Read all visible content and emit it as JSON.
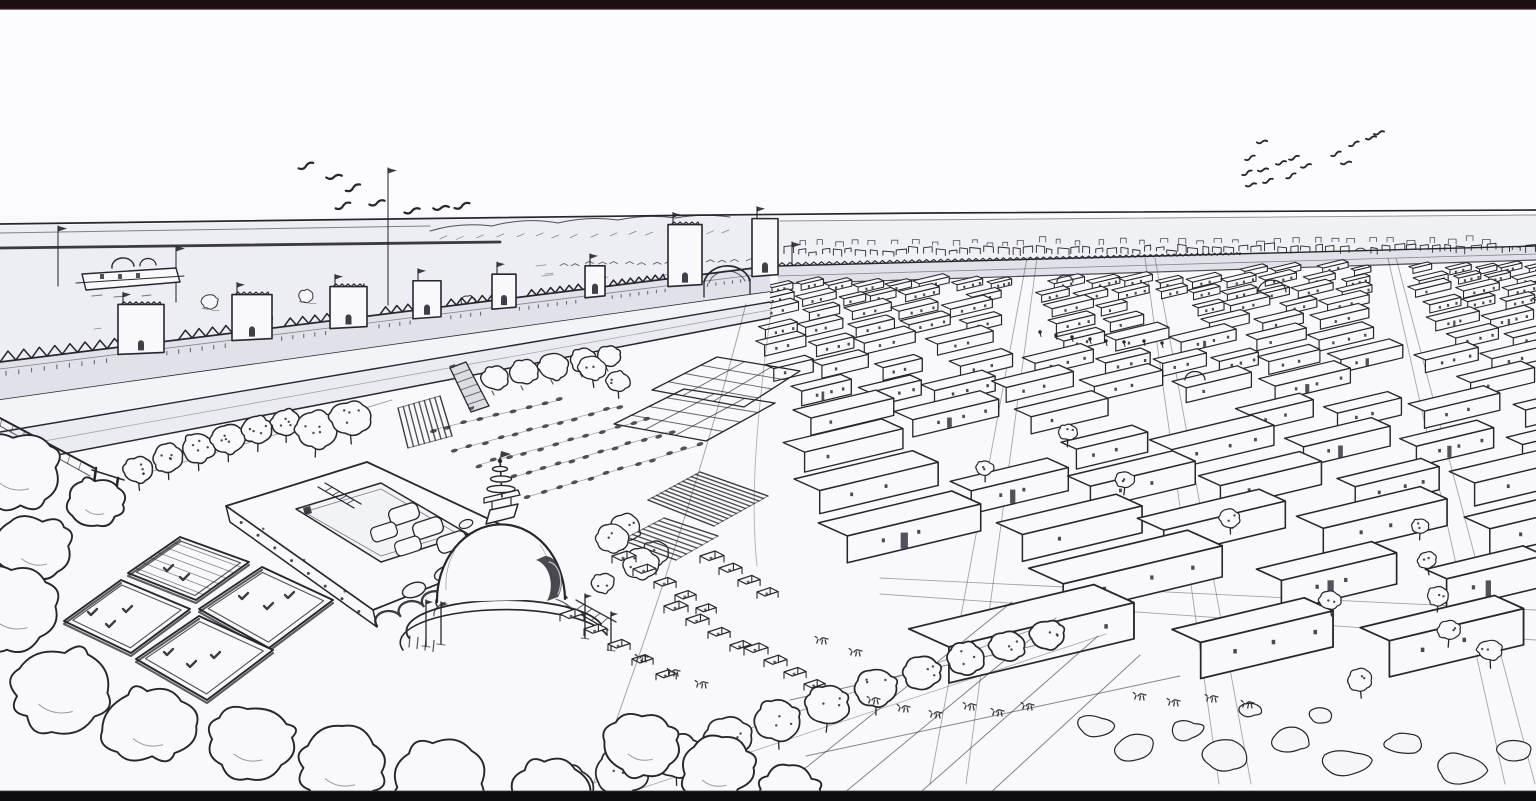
{
  "meta": {
    "title": "Ancient walled city - aerial line drawing",
    "description": "Hand-drawn black-and-white bird's-eye reconstruction of an ancient Indus-style city: a crenellated citadel wall with bastions and gate towers, a great domed stupa with spire, a courtyard granary building, four sunken bath platforms, orchards, garden plots, market stalls, and a vast grid of flat-roofed houses stretching to the horizon under a pale sky with two flocks of birds. Letterboxed video frame, no visible text.",
    "visible_text": "none"
  },
  "palette": {
    "ink": "#26262c",
    "ink_soft": "#5a5a63",
    "paper": "#f9f9fb",
    "sky": "#fcfcfe",
    "wash_plain": "#edeef3",
    "wash_wall": "#e1e2e9",
    "wash_berm": "#f3f4f7",
    "wash_road": "#eaecf1",
    "wash_band": "#f0f1f5",
    "dark_fill": "#35353d",
    "bar_top": "#1c0f12",
    "bar_bottom": "#0d0c0e",
    "bar_edge": "#421b20"
  },
  "letterbox": {
    "top_height": 9,
    "bottom_height": 10
  },
  "horizon": {
    "y_left": 224,
    "y_right": 210
  },
  "birds": {
    "left_flock": [
      [
        306,
        166
      ],
      [
        334,
        177
      ],
      [
        353,
        188
      ],
      [
        343,
        206
      ],
      [
        377,
        203
      ],
      [
        412,
        211
      ],
      [
        441,
        208
      ],
      [
        462,
        206
      ]
    ],
    "right_flock": [
      [
        1262,
        142
      ],
      [
        1250,
        158
      ],
      [
        1281,
        163
      ],
      [
        1263,
        170
      ],
      [
        1247,
        173
      ],
      [
        1268,
        181
      ],
      [
        1251,
        185
      ],
      [
        1294,
        158
      ],
      [
        1306,
        166
      ],
      [
        1291,
        176
      ],
      [
        1336,
        154
      ],
      [
        1346,
        163
      ],
      [
        1354,
        144
      ],
      [
        1371,
        138
      ],
      [
        1379,
        133
      ]
    ]
  },
  "flag_poles": [
    [
      58,
      226,
      286
    ],
    [
      176,
      246,
      302
    ],
    [
      388,
      168,
      305
    ],
    [
      792,
      242,
      290
    ]
  ],
  "wall": {
    "towers": [
      [
        118,
        46,
        40
      ],
      [
        232,
        40,
        36
      ],
      [
        330,
        37,
        32
      ],
      [
        413,
        28,
        28
      ],
      [
        492,
        24,
        25
      ],
      [
        585,
        20,
        22
      ]
    ],
    "gateway": [
      [
        668,
        34,
        52
      ],
      [
        752,
        26,
        48
      ]
    ]
  },
  "roadside_trees": [
    [
      495,
      378,
      13
    ],
    [
      524,
      372,
      14
    ],
    [
      554,
      366,
      14
    ],
    [
      583,
      360,
      13
    ],
    [
      609,
      356,
      11
    ]
  ],
  "orchard_trees": [
    [
      138,
      470,
      14
    ],
    [
      168,
      458,
      15
    ],
    [
      198,
      448,
      16
    ],
    [
      228,
      439,
      16
    ],
    [
      258,
      430,
      15
    ],
    [
      286,
      422,
      14
    ],
    [
      316,
      430,
      20
    ],
    [
      350,
      418,
      19
    ]
  ],
  "stupa_bushes": [
    [
      612,
      538,
      15
    ],
    [
      641,
      564,
      17
    ],
    [
      603,
      583,
      11
    ]
  ],
  "mid_trees": [
    [
      592,
      368,
      13
    ],
    [
      618,
      381,
      11
    ],
    [
      625,
      528,
      15
    ],
    [
      655,
      553,
      13
    ]
  ],
  "town_trees": [
    [
      1068,
      432,
      9
    ],
    [
      1125,
      480,
      9
    ],
    [
      1230,
      518,
      10
    ],
    [
      1427,
      560,
      9
    ],
    [
      1438,
      596,
      10
    ],
    [
      1449,
      630,
      11
    ],
    [
      1420,
      526,
      8
    ],
    [
      985,
      468,
      8
    ],
    [
      1330,
      600,
      10
    ],
    [
      1490,
      650,
      12
    ],
    [
      1360,
      680,
      12
    ]
  ],
  "town_domes": [
    [
      1272,
      292,
      14
    ],
    [
      1195,
      380,
      10
    ],
    [
      1065,
      282,
      8
    ]
  ],
  "street_figures": [
    [
      1040,
      332
    ],
    [
      1056,
      335
    ],
    [
      1072,
      337
    ],
    [
      1090,
      339
    ],
    [
      1106,
      341
    ],
    [
      1124,
      342
    ],
    [
      1144,
      341
    ],
    [
      1162,
      343
    ]
  ],
  "plain_bushes": [
    [
      148,
      318,
      9
    ],
    [
      210,
      302,
      8
    ],
    [
      262,
      320,
      10
    ],
    [
      306,
      296,
      7
    ],
    [
      338,
      330,
      9
    ],
    [
      412,
      322,
      8
    ],
    [
      468,
      302,
      7
    ],
    [
      524,
      332,
      8
    ],
    [
      606,
      318,
      7
    ],
    [
      356,
      362,
      6
    ]
  ],
  "pool_marks": {
    "a": [
      [
        168,
        568
      ],
      [
        184,
        577
      ]
    ],
    "b": [
      [
        92,
        612
      ],
      [
        110,
        624
      ],
      [
        127,
        609
      ]
    ],
    "c": [
      [
        243,
        596
      ],
      [
        268,
        606
      ],
      [
        289,
        595
      ]
    ],
    "d": [
      [
        168,
        652
      ],
      [
        191,
        664
      ],
      [
        215,
        655
      ]
    ]
  },
  "market_stalls": [
    [
      612,
      556,
      21,
      13,
      5
    ],
    [
      700,
      556,
      19,
      12,
      4
    ],
    [
      560,
      614,
      24,
      15,
      5
    ],
    [
      664,
      606,
      22,
      13,
      4
    ],
    [
      744,
      648,
      20,
      12,
      4
    ]
  ],
  "crop_rows": [
    [
      432,
      430,
      560,
      400,
      9
    ],
    [
      455,
      450,
      620,
      406,
      12
    ],
    [
      478,
      465,
      648,
      419,
      12
    ],
    [
      500,
      481,
      672,
      431,
      13
    ],
    [
      527,
      497,
      700,
      445,
      12
    ]
  ],
  "hatch_plots": [
    [
      398,
      408,
      440,
      396,
      452,
      436,
      408,
      448,
      8
    ],
    [
      648,
      500,
      700,
      472,
      768,
      496,
      714,
      526,
      12
    ],
    [
      622,
      540,
      664,
      518,
      718,
      536,
      676,
      560,
      8
    ]
  ],
  "garden_grids": [
    [
      652,
      390,
      717,
      357,
      800,
      371,
      744,
      407,
      3,
      2
    ],
    [
      614,
      424,
      684,
      389,
      775,
      403,
      706,
      441,
      3,
      2
    ]
  ],
  "field_lines": [
    [
      772,
      795,
      1012,
      602
    ],
    [
      838,
      798,
      1056,
      618
    ],
    [
      914,
      798,
      1098,
      636
    ],
    [
      988,
      795,
      1140,
      655
    ],
    [
      806,
      756,
      1180,
      676
    ],
    [
      790,
      700,
      1060,
      640
    ]
  ],
  "foreground_trees": [
    [
      568,
      790,
      26
    ],
    [
      622,
      772,
      25
    ],
    [
      676,
      754,
      24
    ],
    [
      728,
      737,
      23
    ],
    [
      778,
      720,
      22
    ],
    [
      828,
      704,
      21
    ],
    [
      876,
      688,
      20
    ],
    [
      922,
      673,
      19
    ],
    [
      966,
      659,
      18
    ],
    [
      1008,
      646,
      17
    ],
    [
      1048,
      634,
      16
    ]
  ],
  "bushes": [
    [
      16,
      470,
      42
    ],
    [
      96,
      502,
      26
    ],
    [
      36,
      548,
      36
    ],
    [
      14,
      608,
      44
    ],
    [
      58,
      690,
      48
    ],
    [
      150,
      726,
      42
    ],
    [
      250,
      742,
      40
    ],
    [
      342,
      766,
      42
    ],
    [
      440,
      782,
      44
    ],
    [
      548,
      795,
      40
    ],
    [
      642,
      744,
      34
    ],
    [
      716,
      770,
      34
    ],
    [
      788,
      793,
      30
    ]
  ],
  "rocks": [
    [
      1095,
      726,
      18
    ],
    [
      1135,
      748,
      22
    ],
    [
      1185,
      730,
      16
    ],
    [
      1225,
      756,
      24
    ],
    [
      1290,
      740,
      20
    ],
    [
      1345,
      762,
      22
    ],
    [
      1405,
      744,
      18
    ],
    [
      1460,
      770,
      24
    ],
    [
      1515,
      750,
      18
    ],
    [
      1250,
      710,
      12
    ],
    [
      1320,
      716,
      12
    ]
  ],
  "creatures": [
    [
      872,
      700
    ],
    [
      902,
      708
    ],
    [
      934,
      714
    ],
    [
      968,
      706
    ],
    [
      996,
      712
    ],
    [
      1026,
      706
    ],
    [
      1138,
      696
    ],
    [
      1172,
      702
    ],
    [
      1210,
      698
    ],
    [
      1246,
      704
    ],
    [
      640,
      658
    ],
    [
      672,
      672
    ],
    [
      700,
      684
    ],
    [
      820,
      640
    ],
    [
      854,
      652
    ]
  ],
  "streets": [
    [
      1032,
      948,
      5,
      18
    ],
    [
      1150,
      1235,
      5,
      16
    ],
    [
      1392,
      1520,
      4,
      15
    ]
  ],
  "h_street": [
    880,
    585,
    0.05,
    10,
    16
  ],
  "grid": {
    "y0": 260,
    "rows": 16,
    "h0": 7.5,
    "growth": 1.16,
    "left": [
      [
        256,
        778
      ],
      [
        320,
        760
      ],
      [
        400,
        796
      ],
      [
        470,
        816
      ],
      [
        540,
        844
      ],
      [
        600,
        886
      ],
      [
        660,
        958
      ],
      [
        700,
        1028
      ],
      [
        745,
        1180
      ]
    ]
  }
}
